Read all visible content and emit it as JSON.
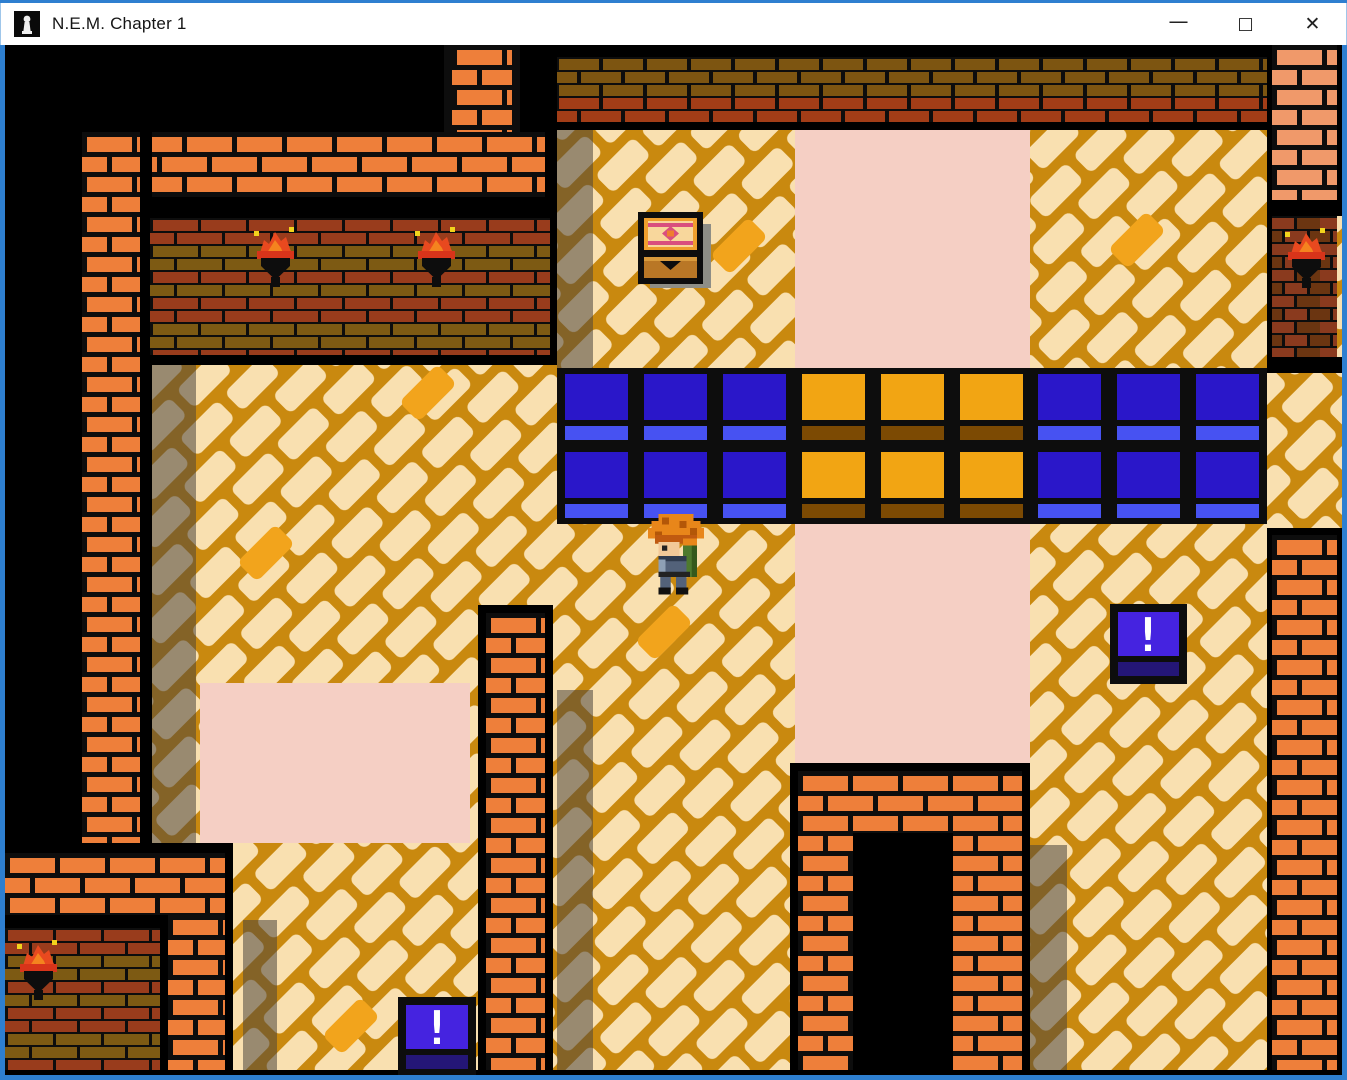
{
  "window": {
    "title": "N.E.M. Chapter 1",
    "controls": {
      "minimize": "—",
      "maximize": "□",
      "close": "✕"
    }
  },
  "game": {
    "exclamation_mark": "!",
    "colors": {
      "floor_brick": "#f9e0b0",
      "floor_mortar": "#c9890f",
      "floor_highlight": "#f2a41c",
      "wall_brick_orange": "#ee7f3a",
      "wall_brick_salmon": "#f0996a",
      "torch_wall_red": "#993c1c",
      "torch_wall_olive": "#7d5a13",
      "band_olive": "#7d5511",
      "band_red": "#a23d17",
      "tile_blue": "#2a17c9",
      "tile_blue_light": "#4752f2",
      "tile_orange": "#f2a513",
      "tile_brown": "#7c4a03",
      "carpet_pink": "#f5cfc4",
      "sign_purple": "#4523e0",
      "sign_purple_dark": "#241677",
      "flame_red": "#e8491f",
      "flame_orange": "#f4831f",
      "spark_yellow": "#f2d41c",
      "window_accent": "#2e7fd0"
    },
    "entities": {
      "chest": "treasure-chest",
      "player": "player-character",
      "torches": 4,
      "exclamation_blocks": 2,
      "doorway": "dark-doorway"
    }
  }
}
